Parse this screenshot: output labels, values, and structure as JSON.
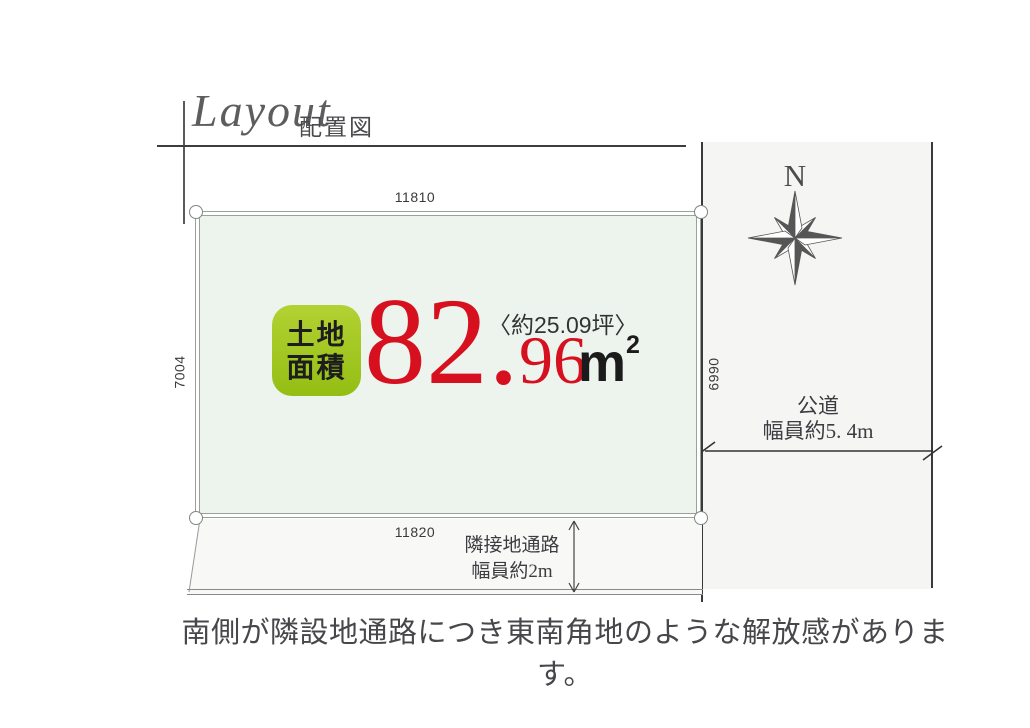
{
  "header": {
    "title_en": "Layout",
    "title_jp": "配置図"
  },
  "plot": {
    "dim_top": "11810",
    "dim_bottom": "11820",
    "dim_left": "7004",
    "dim_right": "6990",
    "area_badge_line1": "土地",
    "area_badge_line2": "面積",
    "area_value_main": "82.",
    "area_value_sub": "96",
    "area_tsubo": "〈約25.09坪〉",
    "area_unit_base": "m",
    "area_unit_sup": "2"
  },
  "road": {
    "compass_n": "N",
    "label_line1": "公道",
    "label_line2": "幅員約5. 4m"
  },
  "passage": {
    "label_line1": "隣接地通路",
    "label_line2": "幅員約2m"
  },
  "caption": "南側が隣設地通路につき東南角地のような解放感があります。",
  "colors": {
    "accent_red": "#d7101f",
    "badge_green_top": "#b3d133",
    "badge_green_bottom": "#94be14",
    "plot_fill": "#edf4ee",
    "road_fill": "#f5f5f3"
  }
}
